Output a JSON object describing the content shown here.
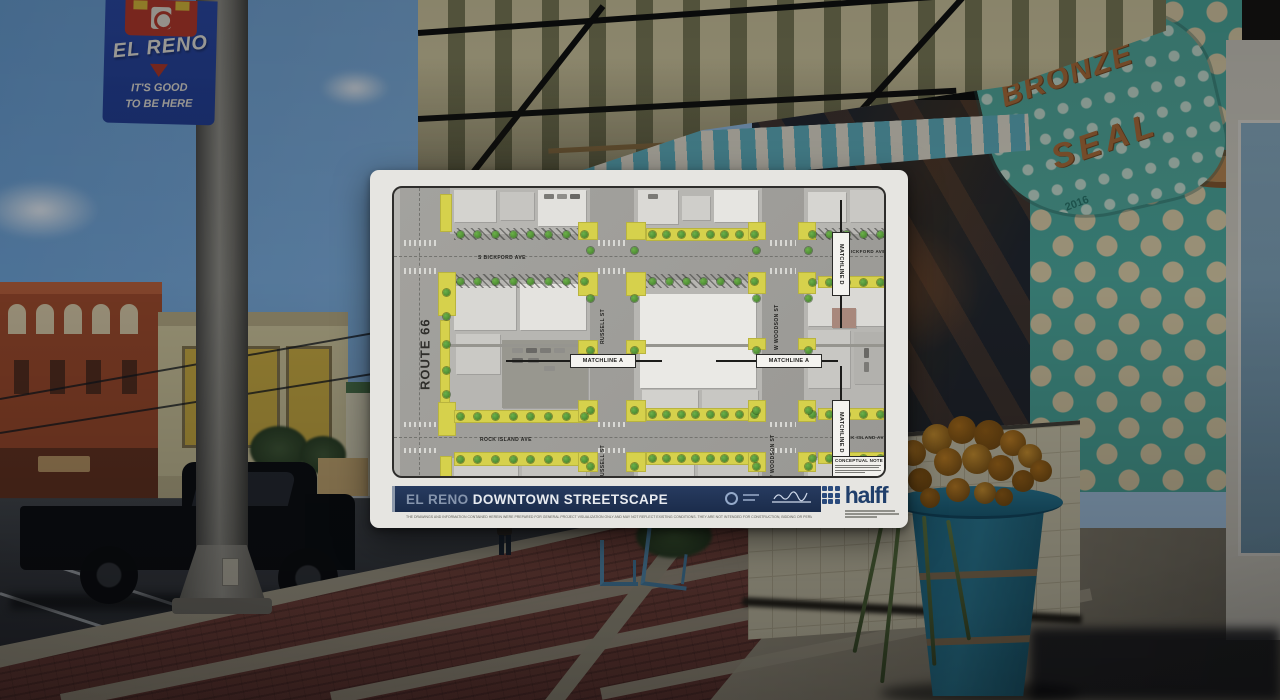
{
  "photo": {
    "pole_banner": {
      "city": "EL RENO",
      "tagline_line1": "IT'S GOOD",
      "tagline_line2": "TO BE HERE"
    },
    "storefront": {
      "sign_line1": "BRONZE",
      "sign_line2": "SEAL",
      "sign_year": "2016"
    }
  },
  "plan_sheet": {
    "title_bar": {
      "project_name": "EL RENO",
      "project_title": "DOWNTOWN STREETSCAPE"
    },
    "brand": {
      "wordmark": "halff"
    },
    "disclaimer": "THE DRAWINGS AND INFORMATION CONTAINED HEREIN WERE PREPARED FOR GENERAL PROJECT VISUALIZATION ONLY AND MAY NOT REFLECT EXISTING CONDITIONS. THEY ARE NOT INTENDED FOR CONSTRUCTION, BIDDING OR PERMIT PURPOSES. HALFF RESERVES THE RIGHT TO REVISE ALL DRAWINGS AND INFORMATION AT ANY TIME WITHOUT NOTIFICATION.",
    "map": {
      "route_66": "ROUTE 66",
      "s_bickford_ave": "S BICKFORD AVE",
      "rock_island_ave": "ROCK ISLAND AVE",
      "russell_st": "RUSSELL ST",
      "w_woodson_st": "W WOODSON ST",
      "matchline_a": "MATCHLINE A",
      "matchline_d": "MATCHLINE D",
      "conceptual_note_title": "CONCEPTUAL NOTE"
    }
  },
  "colors": {
    "title_bar_navy": "#1e3353",
    "halff_navy": "#203f6b",
    "plan_highlight_yellow": "#d6d14c",
    "tree_green": "#4f9a37",
    "banner_blue": "#2c4cae",
    "banner_red": "#c13a2a",
    "storefront_teal": "#4fb0a2"
  }
}
